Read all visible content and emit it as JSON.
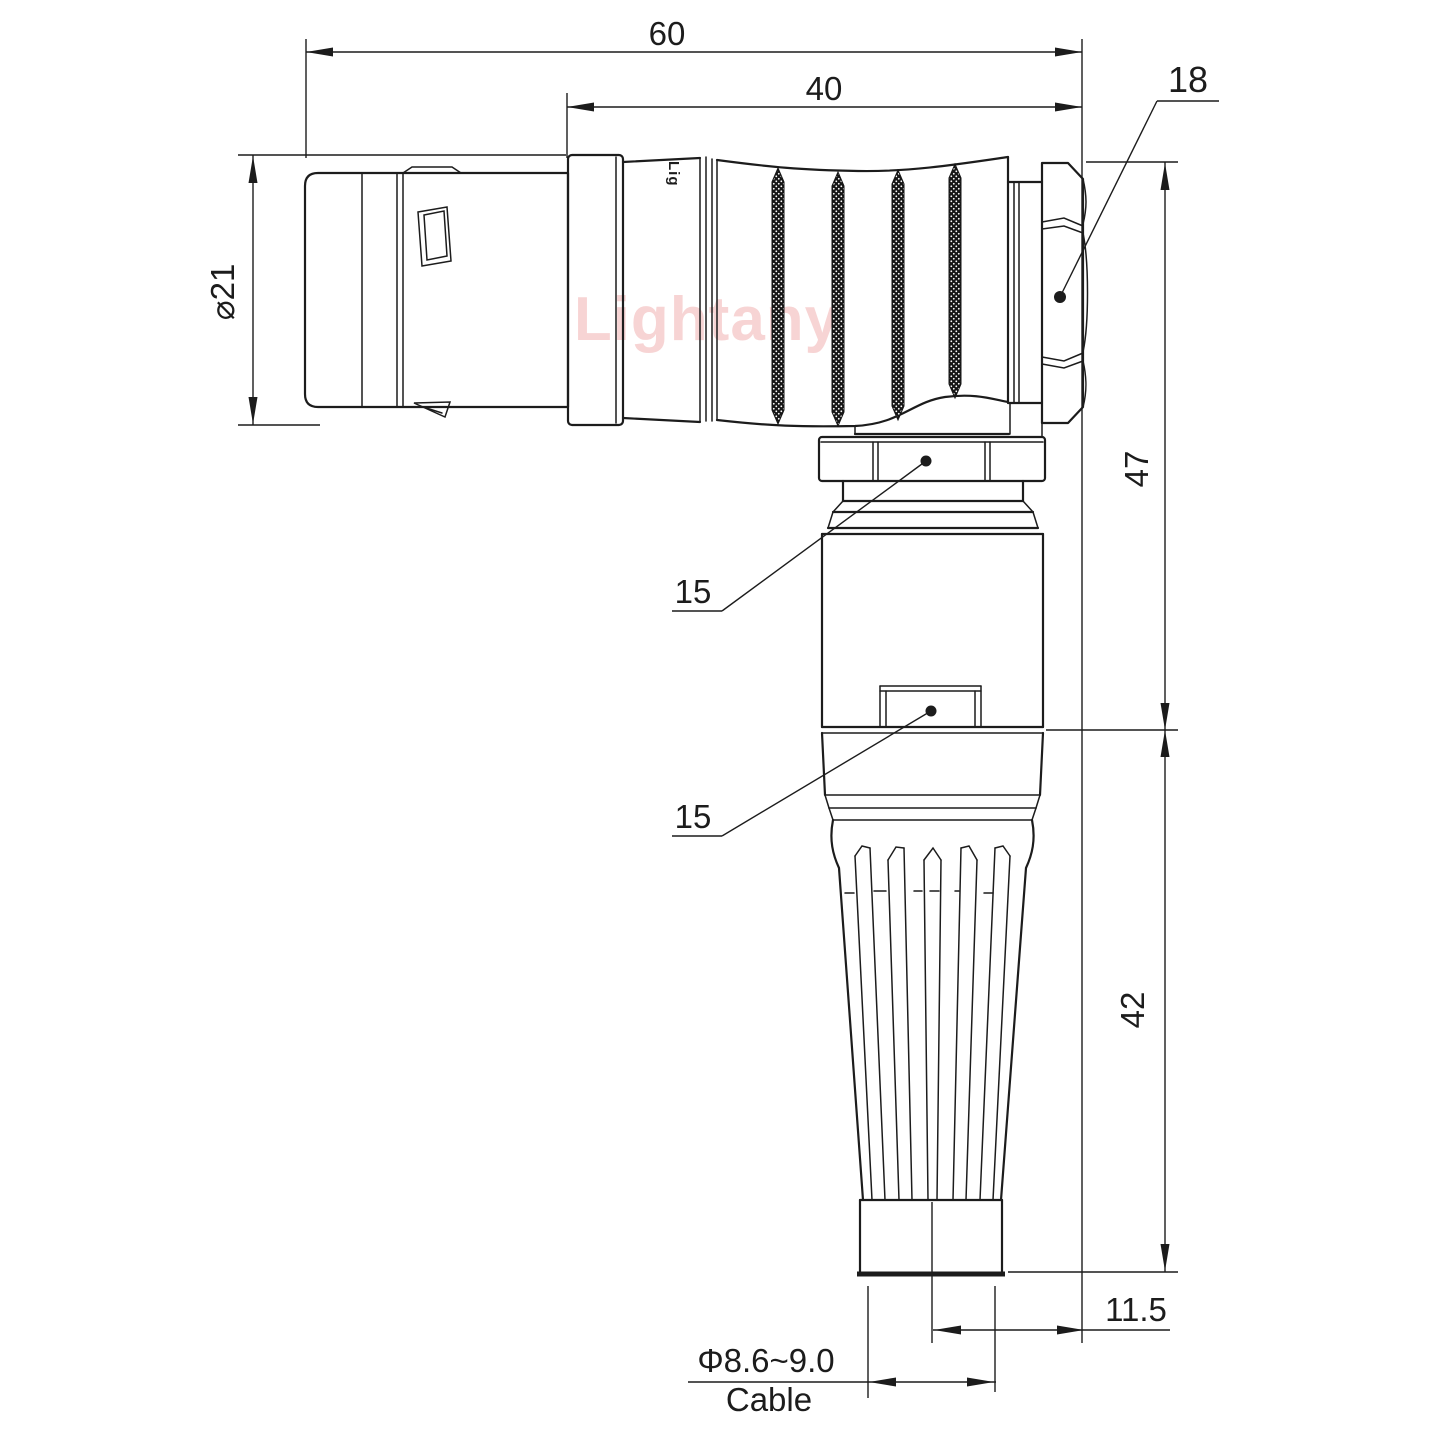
{
  "watermark": {
    "text": "Lightany",
    "color": "#f2b9b9"
  },
  "part": {
    "brand_engraving": "Lig"
  },
  "dimensions": {
    "overall_length": "60",
    "rear_length": "40",
    "hex_nut_size": "18",
    "shell_diameter": "⌀21",
    "elbow_height": "47",
    "callout_top": "15",
    "callout_bottom": "15",
    "boot_length": "42",
    "axis_offset": "11.5",
    "cable_range": "Φ8.6~9.0",
    "cable_label": "Cable"
  },
  "colors": {
    "line": "#1c1c1c",
    "background": "#ffffff"
  }
}
